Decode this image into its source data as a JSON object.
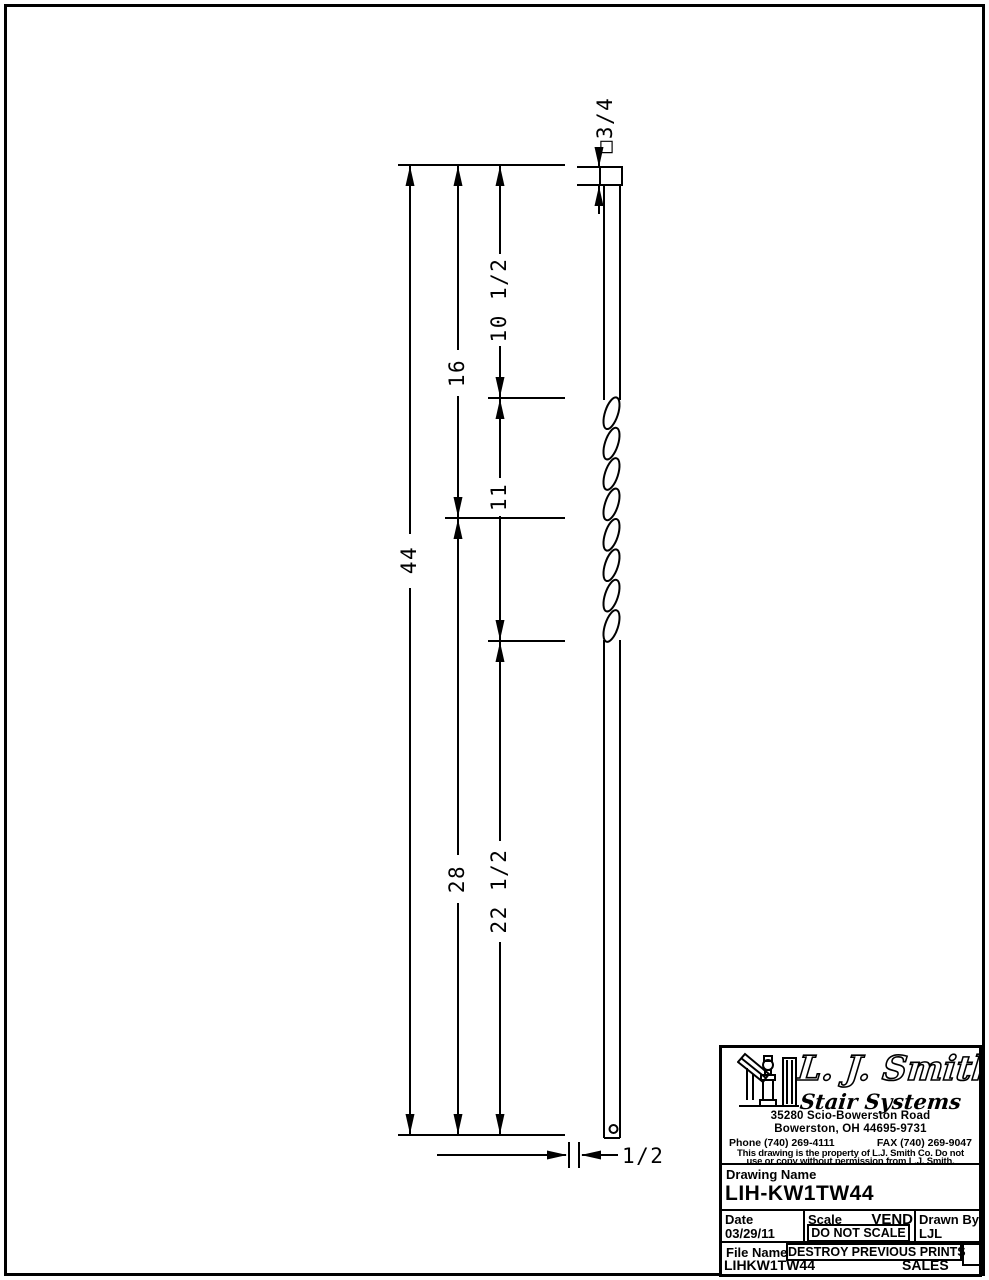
{
  "drawing": {
    "dims": {
      "overall": "44",
      "top_to_twist_mid": "16",
      "twist_mid_to_bottom": "28",
      "top_to_twist_start": "10 1/2",
      "twist_length": "11",
      "twist_end_to_bottom": "22 1/2",
      "top_square": "□3/4",
      "bottom_width": "1/2"
    }
  },
  "title_block": {
    "company": {
      "name": "L. J. Smith",
      "tagline": "Stair Systems",
      "address_line1": "35280 Scio-Bowerston Road",
      "address_line2": "Bowerston, OH 44695-9731",
      "phone": "Phone (740) 269-4111",
      "fax": "FAX (740) 269-9047",
      "notice_line1": "This drawing is the property of L.J. Smith Co. Do not",
      "notice_line2": "use or copy without permission from L.J. Smith."
    },
    "drawing_name_label": "Drawing Name",
    "drawing_name": "LIH-KW1TW44",
    "date_label": "Date",
    "date_value": "03/29/11",
    "scale_label": "Scale",
    "scale_tag": "VEND",
    "scale_value": "DO NOT SCALE",
    "drawn_by_label": "Drawn By",
    "drawn_by_value": "LJL",
    "file_name_label": "File Name",
    "destroy_notice": "DESTROY PREVIOUS PRINTS",
    "file_name_value": "LIHKW1TW44",
    "department": "SALES"
  }
}
